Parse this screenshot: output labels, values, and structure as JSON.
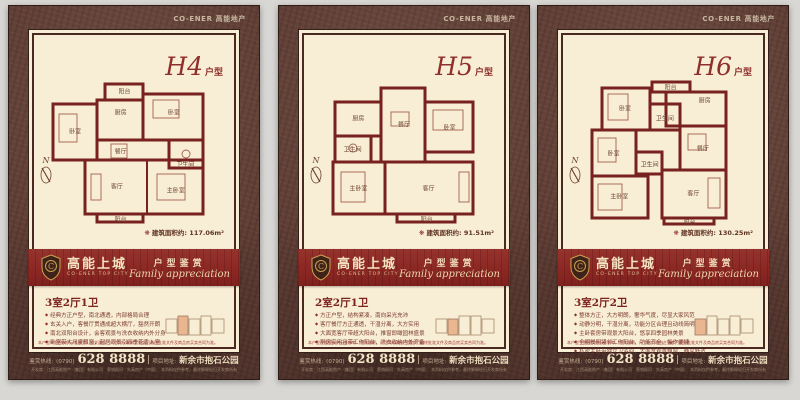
{
  "brand": {
    "top_logo": "CO-ENER 高能地产"
  },
  "banner": {
    "name_cn": "高能上城",
    "name_en": "CO-ENER TOP CITY",
    "right_cn": "户型鉴赏",
    "right_en": "Family appreciation"
  },
  "disclaimer": "本户型平面图仅供示意参考，相关面积、尺寸均以政府主管部门最终批准文件及商品房买卖合同为准。",
  "footer": {
    "hotline_label": "鉴赏热线:",
    "hotline_prefix": "(0790)",
    "phone": "628 8888",
    "address_label": "项目地址:",
    "address": "新余市抱石公园",
    "fine_print": "开发商：江西高能地产（集团）有限公司　营销顾问：先高房产（中国）　本资料仅供参考，最终解释权归开发商所有"
  },
  "panels": [
    {
      "code": "H4",
      "code_suffix": "户型",
      "north_label": "N",
      "area_mark": "❋",
      "area_label": "建筑面积约:",
      "area_value": "117.06m²",
      "layout": "3室2厅1卫",
      "bullets": [
        "经典方正户型，南北通透，内部格局合理",
        "玄关入户，客餐厅贯通成超大横厅，豁然开朗",
        "南北双阳台设计，会客观景与洗衣收纳内外分身",
        "卧室带大尺度飘窗，起居观景引四季花香入室"
      ],
      "rooms": [
        "阳台",
        "卧室",
        "厨房",
        "卧室",
        "餐厅",
        "卫生间",
        "客厅",
        "主卧室",
        "阳台"
      ]
    },
    {
      "code": "H5",
      "code_suffix": "户型",
      "north_label": "N",
      "area_mark": "❋",
      "area_label": "建筑面积约:",
      "area_value": "91.51m²",
      "layout": "2室2厅1卫",
      "bullets": [
        "方正户型，结构紧凑，南向采光充沛",
        "客厅餐厅方正通透，干湿分离，大方实用",
        "大面宽客厅带超大阳台，推窗即瞰园林盛景",
        "厨房实用且带工作阳台，洗衣收纳内外齐备"
      ],
      "rooms": [
        "厨房",
        "卫生间",
        "餐厅",
        "卧室",
        "主卧室",
        "客厅",
        "阳台"
      ]
    },
    {
      "code": "H6",
      "code_suffix": "户型",
      "north_label": "N",
      "area_mark": "❋",
      "area_label": "建筑面积约:",
      "area_value": "130.25m²",
      "layout": "3室2厅2卫",
      "bullets": [
        "整体方正，大方明朗，奢华气度，尽显大家风范",
        "动静分明，干湿分离，功能分区合理且动线简明",
        "主卧套房带观景大阳台，悠享四季园林美景",
        "全明餐厨紧邻工作阳台，功能齐全，操作便捷",
        "私密主卧带独立卫浴间，大面宽观景飘窗，静享舒适"
      ],
      "rooms": [
        "卧室",
        "阳台",
        "厨房",
        "卫生间",
        "餐厅",
        "卧室",
        "卫生间",
        "客厅",
        "主卧室",
        "阳台"
      ]
    }
  ]
}
